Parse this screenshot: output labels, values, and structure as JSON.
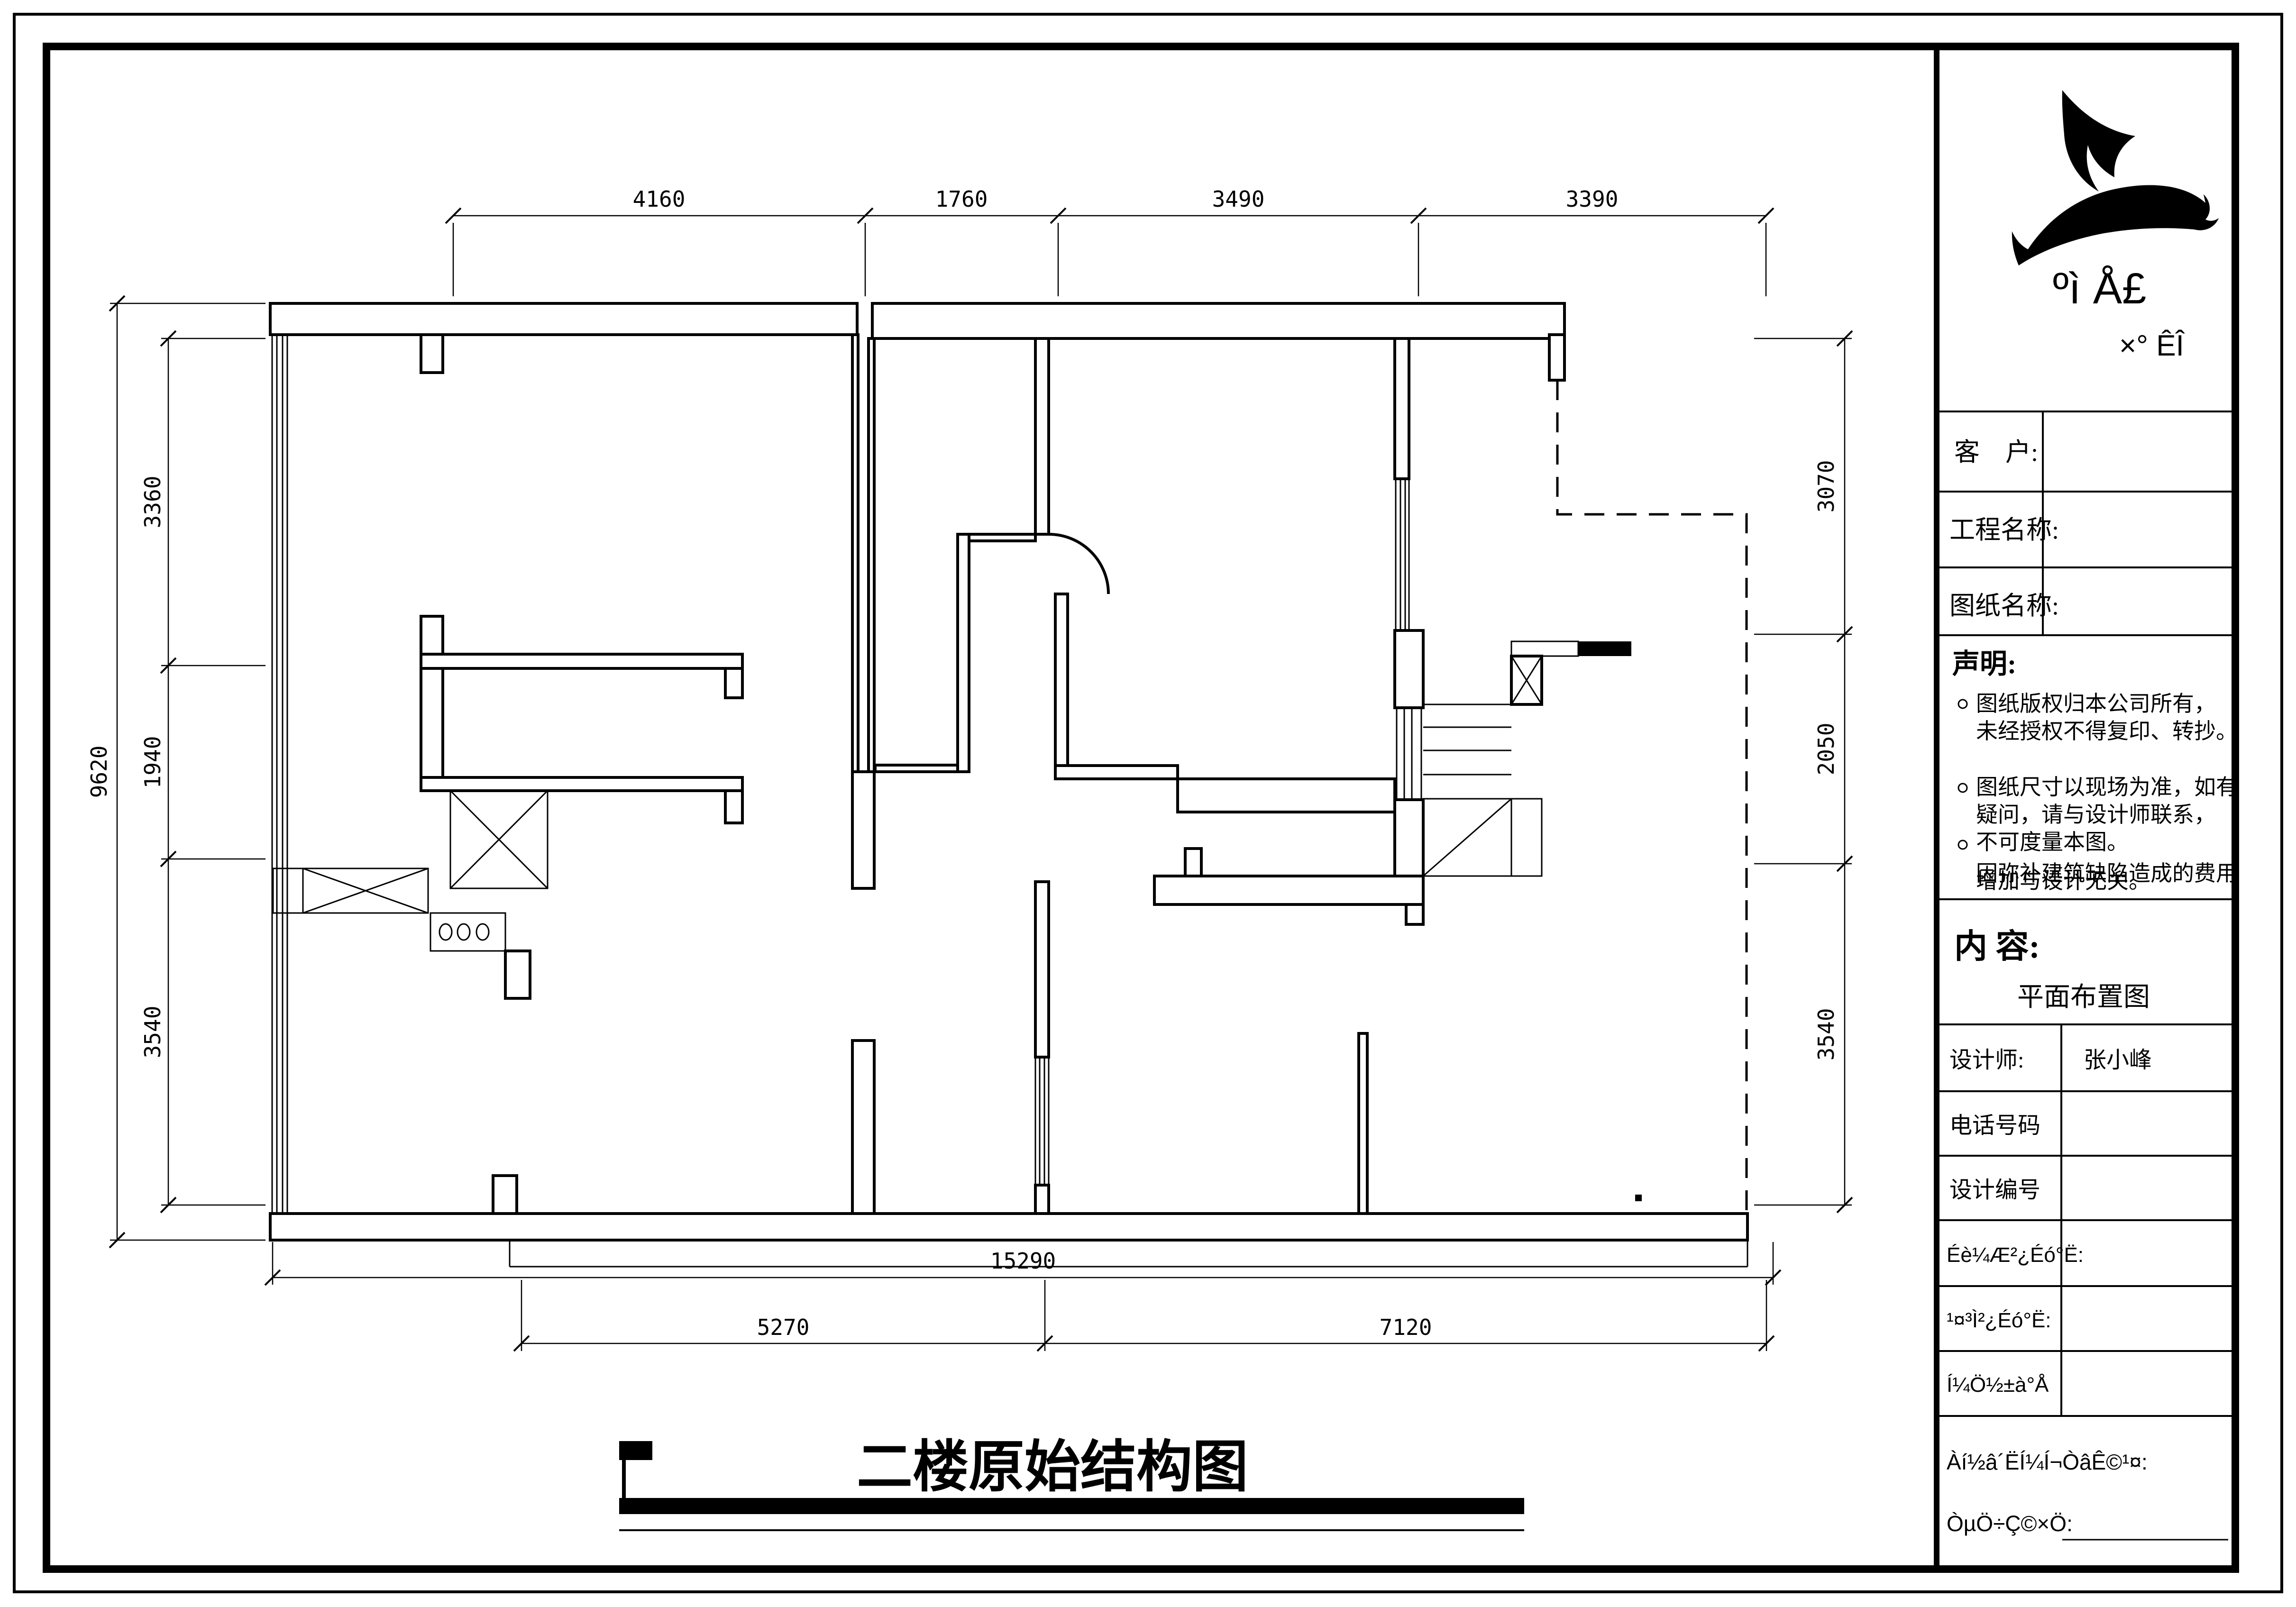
{
  "sheet": {
    "title": "二楼原始结构图"
  },
  "dimensions": {
    "top": [
      "4160",
      "1760",
      "3490",
      "3390"
    ],
    "left_overall": "9620",
    "left": [
      "3360",
      "1940",
      "3540"
    ],
    "right": [
      "3070",
      "2050",
      "3540"
    ],
    "bottom_overall": "15290",
    "bottom": [
      "5270",
      "7120"
    ]
  },
  "title_block": {
    "logo_text_primary": "ºì Å£",
    "logo_text_secondary": "×° ÊÎ",
    "customer_label": "客　户:",
    "project_label": "工程名称:",
    "drawing_label": "图纸名称:",
    "statement": {
      "title": "声明:",
      "lines": [
        "图纸版权归本公司所有，",
        "未经授权不得复印、转抄。",
        "图纸尺寸以现场为准，如有",
        "疑问，请与设计师联系，",
        "不可度量本图。",
        "因弥补建筑缺陷造成的费用",
        "增加与设计无关。"
      ]
    },
    "content_label": "内  容:",
    "content_value": "平面布置图",
    "designer_label": "设计师:",
    "designer_value": "张小峰",
    "phone_label": "电话号码",
    "design_no_label": "设计编号",
    "design_review_label": "Éè¼Æ²¿Éó°Ë:",
    "engineering_review_label": "¹¤³Ì²¿Éó°Ë:",
    "drawing_no_label": "Í¼Ö½±à°Å",
    "agree_label": "Àí½â´ËÍ¼Í¬ÒâÊ©¹¤:",
    "owner_sign_label": "ÒµÖ÷Ç©×Ö:"
  }
}
